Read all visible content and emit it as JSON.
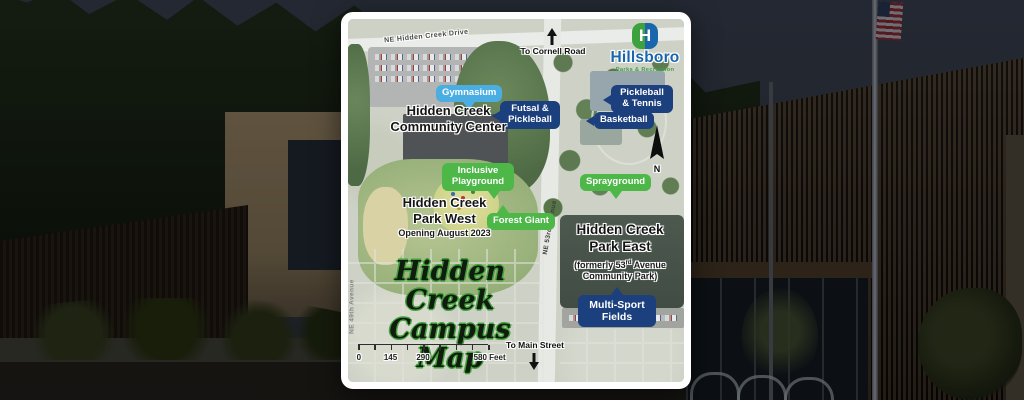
{
  "map": {
    "logo": {
      "title": "Hillsboro",
      "subtitle": "Parks & Recreation",
      "monogram": "H"
    },
    "title": {
      "line1": "Hidden Creek",
      "line2": "Campus Map"
    },
    "streets": {
      "top_road": "NE Hidden Creek Drive",
      "east_road": "NE 53rd Avenue",
      "west_road": "NE 49th Avenue"
    },
    "wayfinding": {
      "north": "To Cornell Road",
      "south": "To Main Street",
      "compass": "N"
    },
    "facilities": {
      "gymnasium": "Gymnasium",
      "futsal_pickleball": "Futsal & Pickleball",
      "pickleball_tennis": "Pickleball & Tennis",
      "basketball": "Basketball",
      "inclusive_playground": "Inclusive Playground",
      "forest_giant": "Forest Giant",
      "sprayground": "Sprayground",
      "multi_sport_fields": "Multi-Sport Fields"
    },
    "areas": {
      "community_center": {
        "line1": "Hidden Creek",
        "line2": "Community Center"
      },
      "park_west": {
        "line1": "Hidden Creek",
        "line2": "Park West",
        "note": "Opening August 2023"
      },
      "park_east": {
        "line1": "Hidden Creek",
        "line2": "Park East",
        "former_pre": "(formerly 53",
        "former_sup": "rd",
        "former_post": " Avenue",
        "former_line2": "Community Park)"
      }
    },
    "scale_bar": {
      "tick0": "0",
      "tick1": "145",
      "tick2": "290",
      "end_label": "580 Feet"
    },
    "colors": {
      "navy": "#1c3f7d",
      "light_blue": "#4aaee2",
      "green": "#4db848",
      "logo_blue": "#1a66ad",
      "logo_green": "#3da23d",
      "title_green": "#44a03c"
    }
  }
}
